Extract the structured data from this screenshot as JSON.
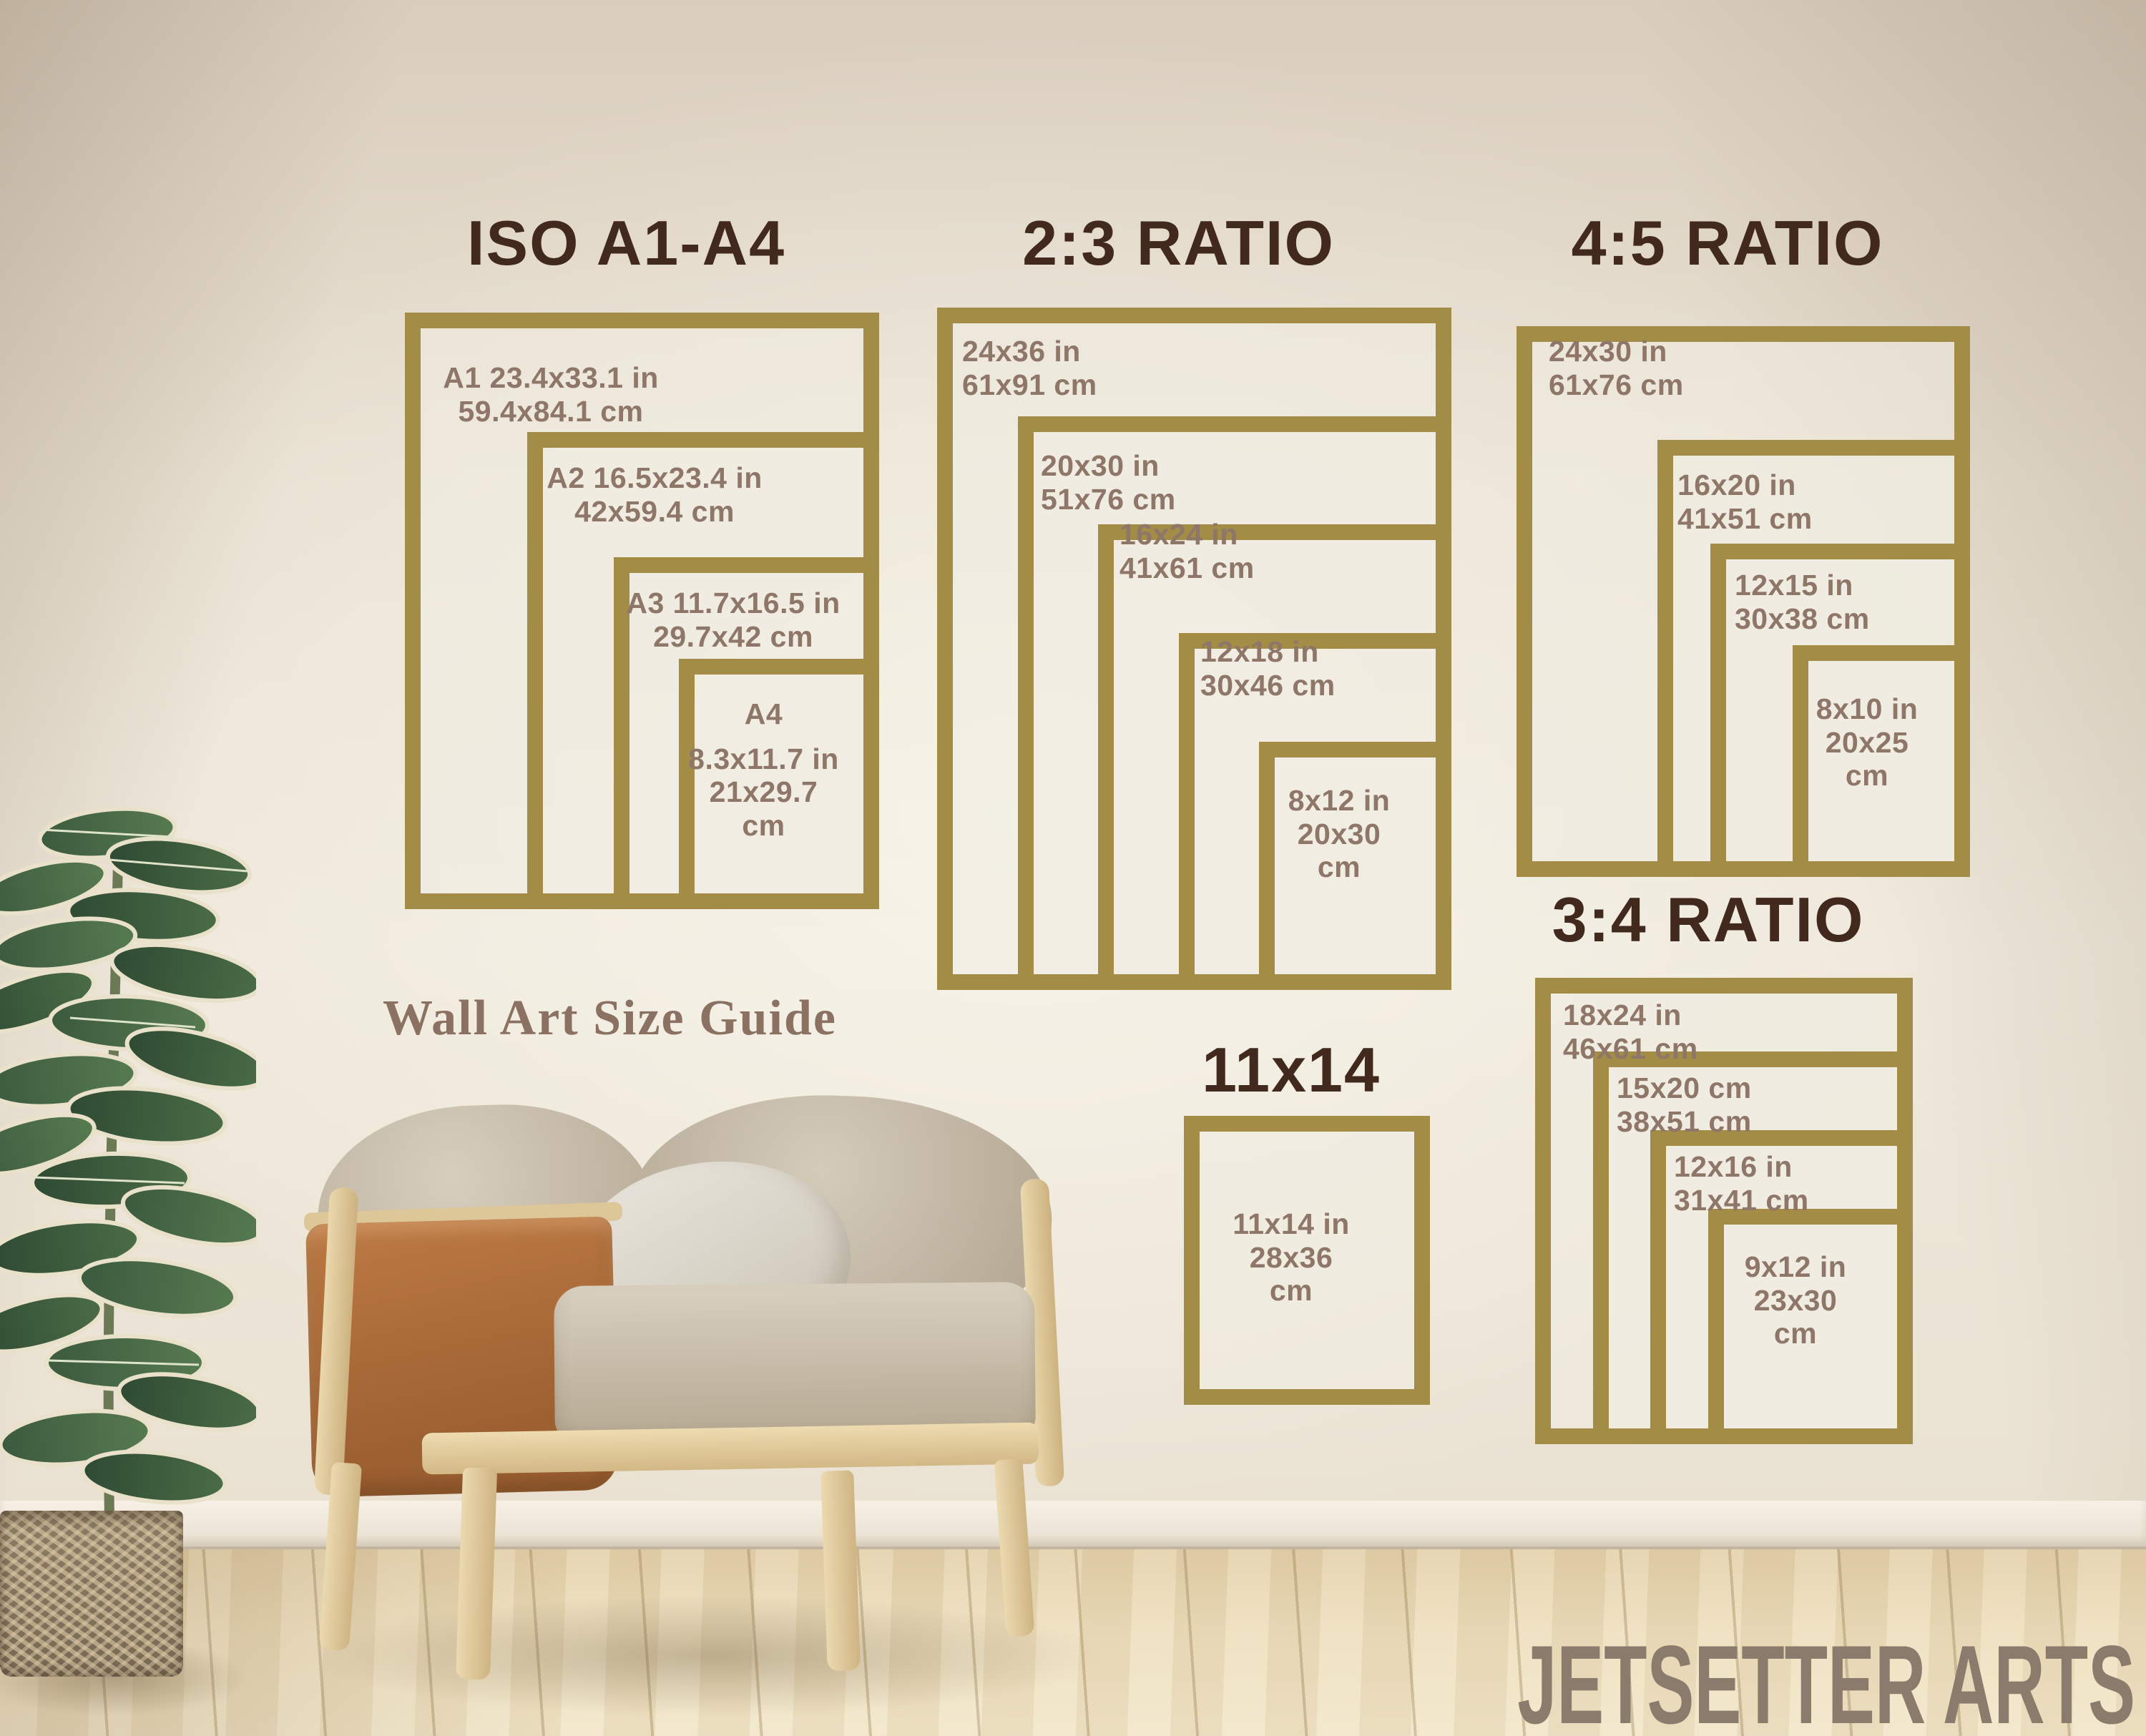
{
  "brand": "JETSETTER ARTS",
  "wall_text": "Wall Art Size Guide",
  "colors": {
    "gold": "#a28c46",
    "title": "#42291e",
    "label": "#8e7668",
    "serif_text": "#8a7162",
    "brand_text": "#8b7b6c"
  },
  "sections": [
    {
      "title": "ISO A1-A4",
      "boxes": [
        {
          "lines": [
            "A1 23.4x33.1 in",
            "59.4x84.1 cm"
          ]
        },
        {
          "lines": [
            "A2 16.5x23.4 in",
            "42x59.4 cm"
          ]
        },
        {
          "lines": [
            "A3 11.7x16.5 in",
            "29.7x42 cm"
          ]
        },
        {
          "lines": [
            "A4",
            "8.3x11.7 in",
            "21x29.7",
            "cm"
          ]
        }
      ]
    },
    {
      "title": "2:3 RATIO",
      "boxes": [
        {
          "lines": [
            "24x36 in",
            "61x91 cm"
          ]
        },
        {
          "lines": [
            "20x30 in",
            "51x76 cm"
          ]
        },
        {
          "lines": [
            "16x24 in",
            "41x61 cm"
          ]
        },
        {
          "lines": [
            "12x18 in",
            "30x46 cm"
          ]
        },
        {
          "lines": [
            "8x12 in",
            "20x30",
            "cm"
          ]
        }
      ]
    },
    {
      "title": "4:5 RATIO",
      "boxes": [
        {
          "lines": [
            "24x30 in",
            "61x76 cm"
          ]
        },
        {
          "lines": [
            "16x20 in",
            "41x51 cm"
          ]
        },
        {
          "lines": [
            "12x15 in",
            "30x38 cm"
          ]
        },
        {
          "lines": [
            "8x10 in",
            "20x25",
            "cm"
          ]
        }
      ]
    },
    {
      "title": "3:4 RATIO",
      "boxes": [
        {
          "lines": [
            "18x24 in",
            "46x61 cm"
          ]
        },
        {
          "lines": [
            "15x20 cm",
            "38x51 cm"
          ]
        },
        {
          "lines": [
            "12x16 in",
            "31x41 cm"
          ]
        },
        {
          "lines": [
            "9x12 in",
            "23x30",
            "cm"
          ]
        }
      ]
    },
    {
      "title": "11x14",
      "boxes": [
        {
          "lines": [
            "11x14 in",
            "28x36",
            "cm"
          ]
        }
      ]
    }
  ]
}
